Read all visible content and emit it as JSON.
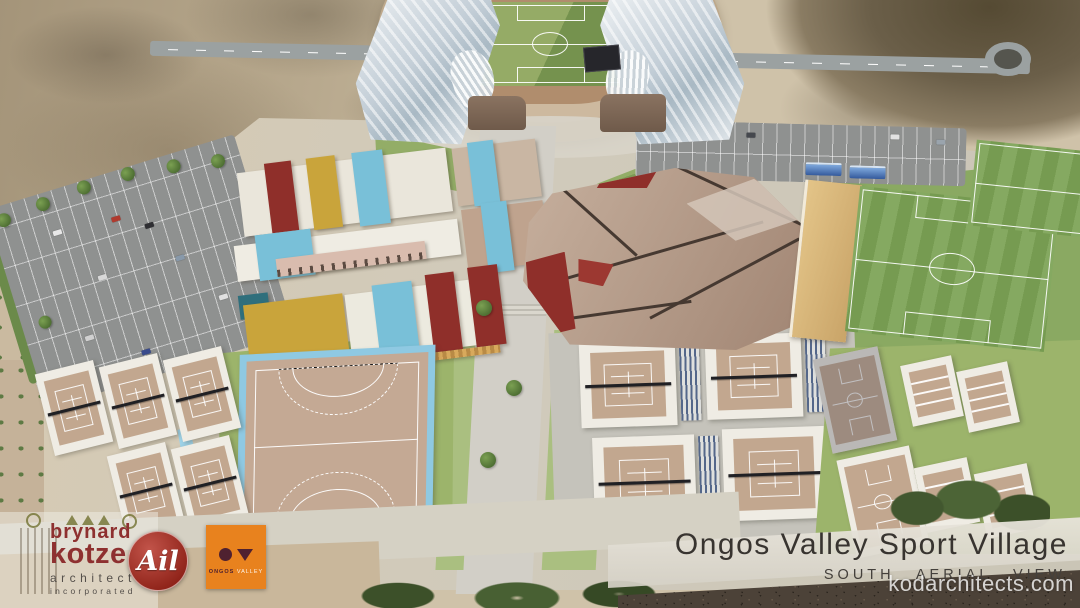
{
  "slide": {
    "title": "Ongos Valley Sport Village",
    "subtitle": "SOUTH AERIAL VIEW",
    "watermark": "kodarchitects.com"
  },
  "logos": {
    "brynard_kotze": {
      "name_line1": "brynard",
      "name_line2": "kotze",
      "descriptor": "architects",
      "sub_descriptor": "incorporated"
    },
    "ail": {
      "monogram": "Ail"
    },
    "ongos_valley": {
      "word1": "ONGOS",
      "word2": "VALLEY"
    }
  },
  "colors": {
    "title_text": "#383430",
    "subtitle_text": "#44403c",
    "brynard_red": "#8e3030",
    "brynard_gray": "#55504b",
    "ail_red_dark": "#8e2218",
    "ail_red_light": "#c2544a",
    "ongos_orange": "#e8821e",
    "ongos_plum": "#4f2130",
    "roof_red": "#8f2f2a",
    "roof_mustard": "#c9a43b",
    "roof_blue": "#79c0d8",
    "roof_teal": "#2f6f7c",
    "arena_tan": "#b49b89",
    "field_green": "#7ca355",
    "hockey_blue": "#8fc9e2",
    "court_tan": "#c2a78f",
    "parking_gray": "#8f9190",
    "sand": "#cfc2a9"
  }
}
